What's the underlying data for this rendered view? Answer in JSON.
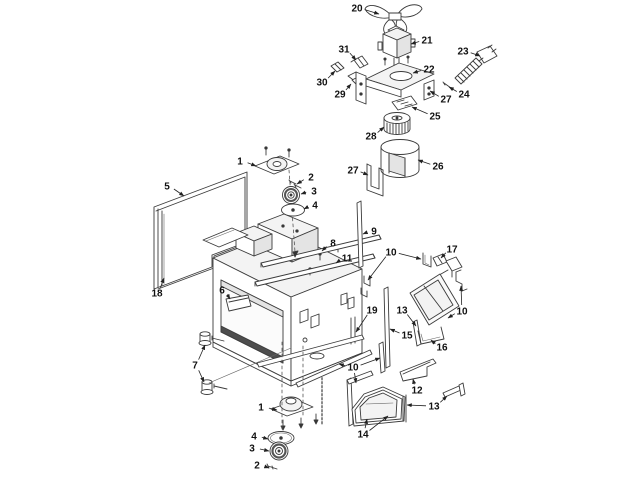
{
  "diagram": {
    "background_color": "#ffffff",
    "line_color": "#3b3b3b",
    "label_color": "#111111",
    "callouts": [
      {
        "n": "20",
        "x": 357,
        "y": 8,
        "arrows": [
          [
            379,
            14
          ]
        ]
      },
      {
        "n": "21",
        "x": 427,
        "y": 40,
        "arrows": [
          [
            411,
            44
          ]
        ]
      },
      {
        "n": "31",
        "x": 344,
        "y": 49,
        "arrows": [
          [
            356,
            60
          ]
        ]
      },
      {
        "n": "23",
        "x": 463,
        "y": 51,
        "arrows": [
          [
            480,
            56
          ]
        ]
      },
      {
        "n": "22",
        "x": 429,
        "y": 69,
        "arrows": [
          [
            413,
            73
          ]
        ]
      },
      {
        "n": "30",
        "x": 322,
        "y": 82,
        "arrows": [
          [
            335,
            71
          ]
        ]
      },
      {
        "n": "29",
        "x": 340,
        "y": 94,
        "arrows": [
          [
            351,
            84
          ]
        ]
      },
      {
        "n": "24",
        "x": 464,
        "y": 94,
        "arrows": [
          [
            449,
            87
          ]
        ]
      },
      {
        "n": "27",
        "x": 446,
        "y": 99,
        "arrows": [
          [
            430,
            91
          ]
        ]
      },
      {
        "n": "25",
        "x": 435,
        "y": 116,
        "arrows": [
          [
            412,
            107
          ]
        ]
      },
      {
        "n": "28",
        "x": 371,
        "y": 136,
        "arrows": [
          [
            384,
            127
          ]
        ]
      },
      {
        "n": "26",
        "x": 438,
        "y": 166,
        "arrows": [
          [
            418,
            160
          ]
        ]
      },
      {
        "n": "27",
        "x": 353,
        "y": 170,
        "arrows": [
          [
            368,
            175
          ]
        ]
      },
      {
        "n": "1",
        "x": 240,
        "y": 161,
        "arrows": [
          [
            256,
            166
          ]
        ]
      },
      {
        "n": "2",
        "x": 311,
        "y": 177,
        "arrows": [
          [
            297,
            184
          ]
        ]
      },
      {
        "n": "3",
        "x": 314,
        "y": 191,
        "arrows": [
          [
            301,
            194
          ]
        ]
      },
      {
        "n": "4",
        "x": 315,
        "y": 205,
        "arrows": [
          [
            304,
            209
          ]
        ]
      },
      {
        "n": "5",
        "x": 167,
        "y": 186,
        "arrows": [
          [
            184,
            196
          ]
        ]
      },
      {
        "n": "18",
        "x": 157,
        "y": 293,
        "arrows": [
          [
            164,
            278
          ]
        ]
      },
      {
        "n": "6",
        "x": 222,
        "y": 290,
        "arrows": [
          [
            230,
            299
          ]
        ]
      },
      {
        "n": "8",
        "x": 333,
        "y": 243,
        "arrows": [
          [
            322,
            251
          ]
        ]
      },
      {
        "n": "9",
        "x": 374,
        "y": 231,
        "arrows": [
          [
            363,
            234
          ]
        ]
      },
      {
        "n": "11",
        "x": 347,
        "y": 258,
        "arrows": [
          [
            336,
            263
          ]
        ]
      },
      {
        "n": "10",
        "x": 391,
        "y": 252,
        "arrows": [
          [
            368,
            280
          ],
          [
            421,
            259
          ]
        ]
      },
      {
        "n": "17",
        "x": 452,
        "y": 249,
        "arrows": [
          [
            441,
            258
          ]
        ]
      },
      {
        "n": "19",
        "x": 372,
        "y": 310,
        "arrows": [
          [
            356,
            332
          ]
        ]
      },
      {
        "n": "13",
        "x": 402,
        "y": 310,
        "arrows": [
          [
            416,
            326
          ]
        ]
      },
      {
        "n": "10",
        "x": 462,
        "y": 311,
        "arrows": [
          [
            461,
            286
          ],
          [
            448,
            318
          ]
        ]
      },
      {
        "n": "15",
        "x": 407,
        "y": 335,
        "arrows": [
          [
            390,
            329
          ]
        ]
      },
      {
        "n": "16",
        "x": 442,
        "y": 347,
        "arrows": [
          [
            431,
            340
          ]
        ]
      },
      {
        "n": "7",
        "x": 195,
        "y": 365,
        "arrows": [
          [
            205,
            345
          ],
          [
            204,
            382
          ]
        ]
      },
      {
        "n": "10",
        "x": 353,
        "y": 367,
        "arrows": [
          [
            339,
            364
          ],
          [
            380,
            358
          ],
          [
            356,
            383
          ]
        ]
      },
      {
        "n": "12",
        "x": 417,
        "y": 390,
        "arrows": [
          [
            413,
            379
          ]
        ]
      },
      {
        "n": "13",
        "x": 434,
        "y": 406,
        "arrows": [
          [
            407,
            405
          ],
          [
            447,
            396
          ]
        ]
      },
      {
        "n": "14",
        "x": 363,
        "y": 434,
        "arrows": [
          [
            367,
            419
          ],
          [
            388,
            416
          ]
        ]
      },
      {
        "n": "1",
        "x": 261,
        "y": 407,
        "arrows": [
          [
            277,
            410
          ]
        ]
      },
      {
        "n": "4",
        "x": 254,
        "y": 436,
        "arrows": [
          [
            268,
            439
          ]
        ]
      },
      {
        "n": "3",
        "x": 252,
        "y": 448,
        "arrows": [
          [
            269,
            451
          ]
        ]
      },
      {
        "n": "2",
        "x": 257,
        "y": 465,
        "arrows": [
          [
            269,
            468
          ]
        ]
      }
    ]
  }
}
